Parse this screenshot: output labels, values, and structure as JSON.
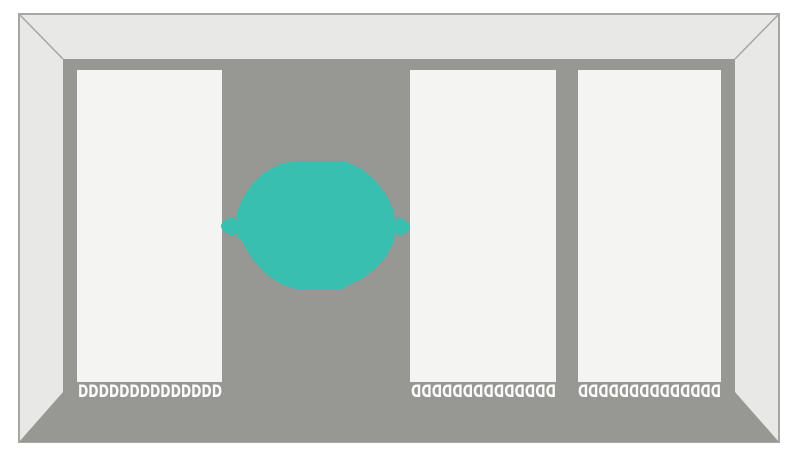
{
  "scene": {
    "colors": {
      "background": "#FFFFFF",
      "wall": "#E8E8E6",
      "wall_outline": "#A6A6A3",
      "floor": "#979794",
      "panel": "#F4F4F2",
      "blob": "#38BFAF",
      "teeth": "#FCFCFA"
    },
    "blob": {
      "shape": "low-poly-blob-with-side-tips",
      "color": "#38BFAF"
    },
    "panels": [
      {
        "position": "left",
        "teeth": "DDDDDDDDDDDDDD",
        "teeth_count": 14,
        "teeth_facing": "right"
      },
      {
        "position": "middle",
        "teeth": "DDDDDDDDDDDDDD",
        "teeth_count": 14,
        "teeth_facing": "left"
      },
      {
        "position": "right",
        "teeth": "DDDDDDDDDDDDDD",
        "teeth_count": 14,
        "teeth_facing": "left"
      }
    ]
  }
}
